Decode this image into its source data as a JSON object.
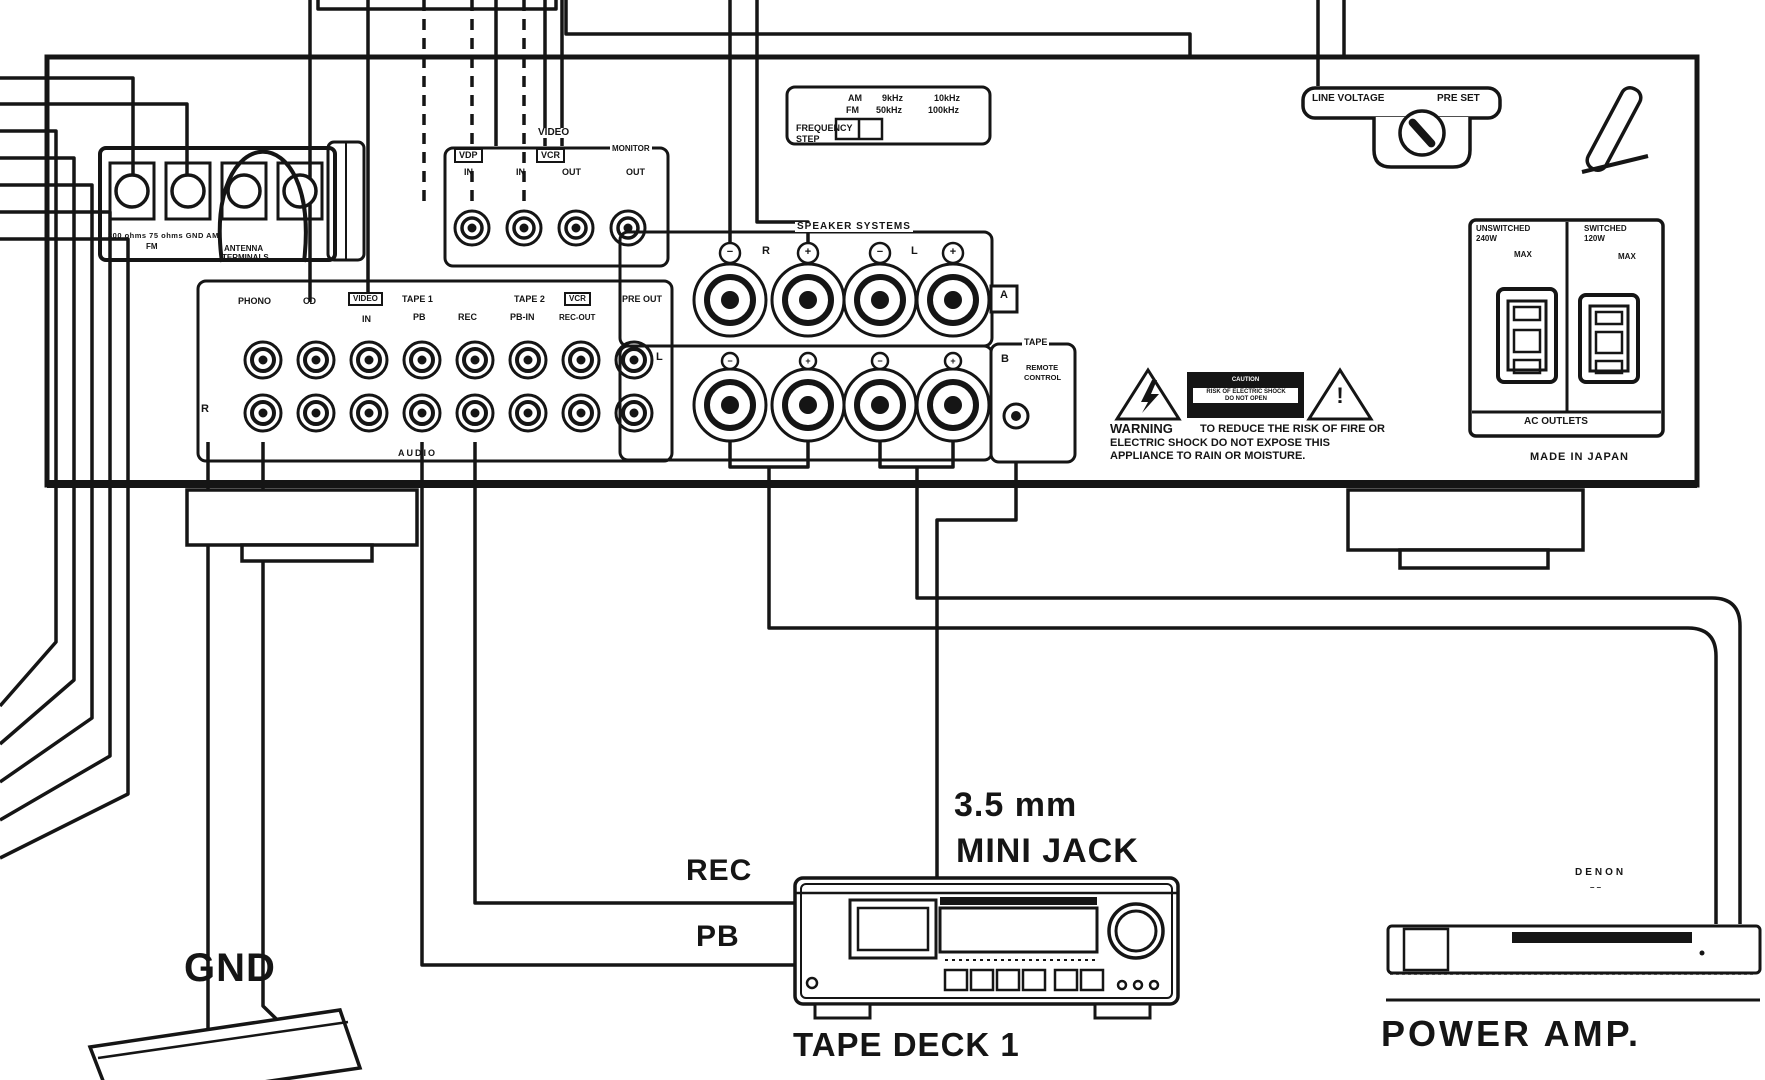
{
  "panel": {
    "antenna": {
      "impedance": "300 ohms   75 ohms   GND   AM",
      "fm": "FM",
      "antenna": "ANTENNA",
      "terminals": "TERMINALS"
    },
    "video": {
      "header": "VIDEO",
      "vdp": "VDP",
      "vcr": "VCR",
      "in1": "IN",
      "in2": "IN",
      "out1": "OUT",
      "monitor": "MONITOR",
      "out2": "OUT"
    },
    "freq": {
      "am": "AM",
      "khz9": "9kHz",
      "khz10": "10kHz",
      "fm": "FM",
      "khz50": "50kHz",
      "khz100": "100kHz",
      "frequency": "FREQUENCY",
      "step": "STEP"
    },
    "line_voltage": {
      "line_voltage": "LINE VOLTAGE",
      "pre_set": "PRE SET"
    },
    "audio": {
      "phono": "PHONO",
      "cd": "CD",
      "video": "VIDEO",
      "video_in": "IN",
      "tape1": "TAPE 1",
      "pb": "PB",
      "rec": "REC",
      "tape2": "TAPE 2",
      "pb_in": "PB-IN",
      "vcr": "VCR",
      "rec_out": "REC-OUT",
      "pre_out": "PRE OUT",
      "l": "L",
      "r": "R",
      "audio": "AUDIO"
    },
    "speakers": {
      "header": "SPEAKER SYSTEMS",
      "r": "R",
      "l": "L",
      "a": "A",
      "b": "B",
      "minus": "−",
      "plus": "+"
    },
    "remote": {
      "tape": "TAPE",
      "remote": "REMOTE",
      "control": "CONTROL"
    },
    "warning": {
      "title": "WARNING",
      "line1": "TO REDUCE THE RISK OF FIRE OR",
      "line2": "ELECTRIC SHOCK DO NOT EXPOSE THIS",
      "line3": "APPLIANCE TO RAIN OR MOISTURE.",
      "caution": "CAUTION",
      "risk": "RISK OF ELECTRIC SHOCK",
      "open": "DO NOT OPEN",
      "bang": "!"
    },
    "ac": {
      "unswitched": "UNSWITCHED",
      "w240": "240W",
      "max1": "MAX",
      "switched": "SWITCHED",
      "w120": "120W",
      "max2": "MAX",
      "outlets": "AC OUTLETS",
      "made": "MADE IN JAPAN"
    }
  },
  "callouts": {
    "rec": "REC",
    "pb": "PB",
    "gnd": "GND",
    "jack1": "3.5 mm",
    "jack2": "MINI JACK",
    "tape_deck": "TAPE DECK 1",
    "power_amp": "POWER AMP.",
    "brand": "DENON",
    "brand_dash": "– –"
  }
}
